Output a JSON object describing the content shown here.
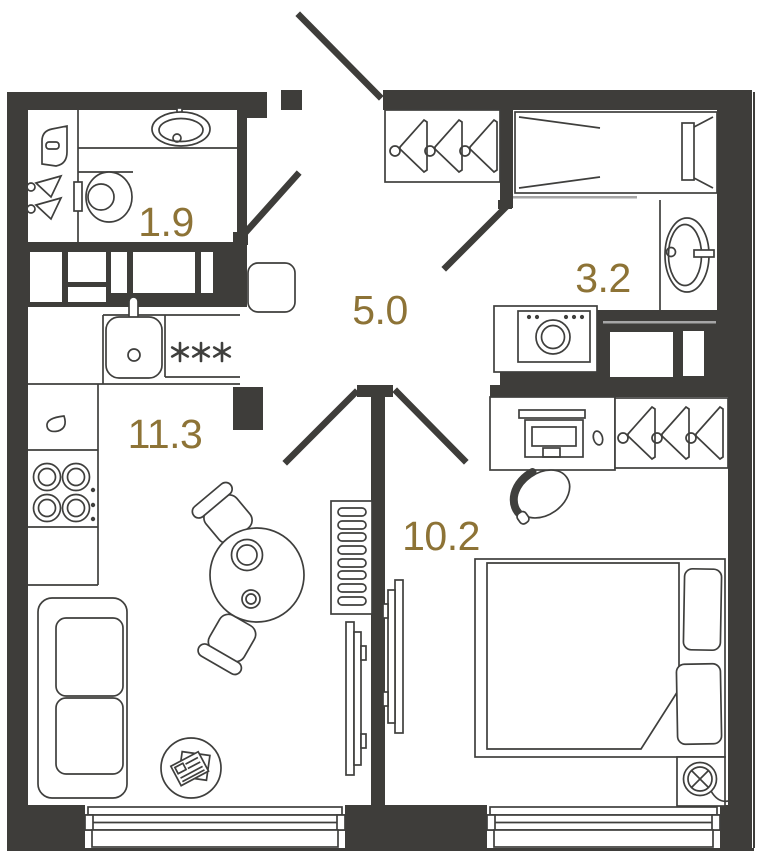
{
  "rooms": {
    "bathroom": {
      "area": "1.9"
    },
    "hallway": {
      "area": "5.0"
    },
    "bathroom_large": {
      "area": "3.2"
    },
    "kitchen_living": {
      "area": "11.3"
    },
    "bedroom": {
      "area": "10.2"
    }
  },
  "colors": {
    "wall": "#3e3d3a",
    "line": "#3f3f3d",
    "area_label": "#8d7336",
    "background": "#ffffff",
    "light_line": "#a6a6a6"
  },
  "icons": [
    "bathtub-icon",
    "bathroom-sink-icon",
    "toilet-icon",
    "water-heater-icon",
    "towel-hook-icon",
    "kitchen-sink-icon",
    "faucet-icon",
    "hob-asterisks-icon",
    "stove-burners-icon",
    "knob-dots-icon",
    "hanger-icon",
    "wardrobe-icon",
    "hallway-cabinet-icon",
    "washing-machine-icon",
    "sofa-icon",
    "dining-table-icon",
    "chair-icon",
    "magazine-table-icon",
    "radiator-icon",
    "tv-icon",
    "desk-icon",
    "computer-icon",
    "mouse-icon",
    "desk-chair-icon",
    "double-bed-icon",
    "pillow-icon",
    "duvet-icon",
    "ceiling-lamp-icon",
    "window",
    "door-swing"
  ]
}
